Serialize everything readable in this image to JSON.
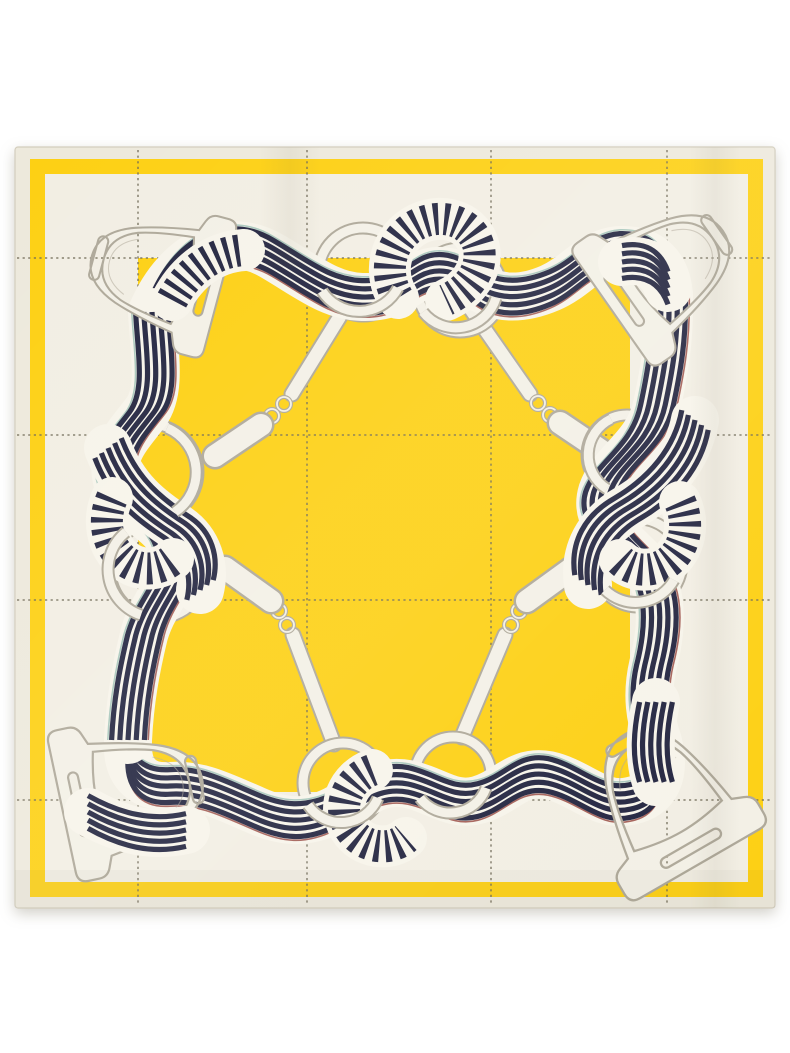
{
  "image": {
    "kind": "product-photo",
    "subject": "square silk twill scarf, equestrian print, folded flat on white background",
    "motifs": "navy-and-white striped ribbon weaving through stirrups, snaffle bits and rings around a solid yellow center with stitched windowpane grid"
  },
  "palette": {
    "page-bg": "#ffffff",
    "yellow": "#fdd013",
    "hem-cream": "#ede9dc",
    "field-cream": "#f2eee3",
    "navy": "#232540",
    "ribbon-white": "#f7f4ea",
    "hw": "#f3f0e6",
    "hw-line": "#aea899",
    "grid": "#6e6955",
    "fringe-red": "#8a3028",
    "fringe-teal": "#90b9ad",
    "edge-line": "#d3cdbd"
  },
  "elements": {
    "stirrups": 4,
    "rings": 8,
    "snaffle_bits": 4,
    "border": "yellow band inset on ivory hem",
    "center": "solid yellow square",
    "grid": "dashed stitch windowpane lines"
  }
}
